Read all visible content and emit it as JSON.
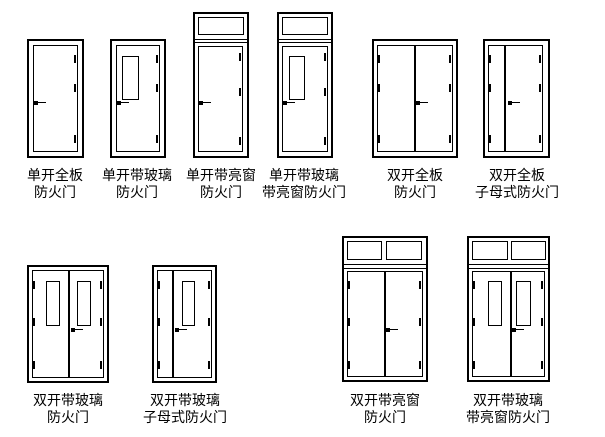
{
  "page": {
    "title": "防火门类型图例",
    "background_color": "#ffffff",
    "line_color": "#000000"
  },
  "doors": [
    {
      "id": "single-solid",
      "type": "single",
      "features": [],
      "label": [
        "单开全板",
        "防火门"
      ],
      "box": [
        27,
        39,
        57,
        119
      ],
      "label_center_x": 55,
      "label_top": 168,
      "leaves": [
        [
          6,
          6,
          45,
          107
        ]
      ],
      "glass": [],
      "transom_panes": [],
      "hlines": [],
      "hinges": [
        [
          47,
          16
        ],
        [
          47,
          45
        ],
        [
          47,
          96
        ]
      ],
      "handle": [
        7,
        62
      ]
    },
    {
      "id": "single-glass",
      "type": "single",
      "features": [
        "glass"
      ],
      "label": [
        "单开带玻璃",
        "防火门"
      ],
      "box": [
        110,
        39,
        56,
        119
      ],
      "label_center_x": 137,
      "label_top": 168,
      "leaves": [
        [
          6,
          6,
          44,
          107
        ]
      ],
      "glass": [
        [
          12,
          17,
          17,
          44
        ]
      ],
      "transom_panes": [],
      "hlines": [],
      "hinges": [
        [
          46,
          16
        ],
        [
          46,
          45
        ],
        [
          46,
          96
        ]
      ],
      "handle": [
        7,
        62
      ]
    },
    {
      "id": "single-transom",
      "type": "single",
      "features": [
        "transom"
      ],
      "label": [
        "单开带亮窗",
        "防火门"
      ],
      "box": [
        193,
        12,
        56,
        146
      ],
      "label_center_x": 221,
      "label_top": 168,
      "leaves": [
        [
          5,
          34,
          45,
          106
        ]
      ],
      "glass": [],
      "transom_panes": [
        [
          5,
          5,
          46,
          18
        ]
      ],
      "hlines": [
        27,
        30
      ],
      "hinges": [
        [
          46,
          41
        ],
        [
          46,
          76
        ],
        [
          46,
          125
        ]
      ],
      "handle": [
        6,
        89
      ]
    },
    {
      "id": "single-glass-transom",
      "type": "single",
      "features": [
        "glass",
        "transom"
      ],
      "label": [
        "单开带玻璃",
        "带亮窗防火门"
      ],
      "box": [
        277,
        12,
        56,
        146
      ],
      "label_center_x": 304,
      "label_top": 168,
      "leaves": [
        [
          5,
          34,
          46,
          106
        ]
      ],
      "glass": [
        [
          12,
          44,
          16,
          44
        ]
      ],
      "transom_panes": [
        [
          5,
          5,
          46,
          18
        ]
      ],
      "hlines": [
        27,
        30
      ],
      "hinges": [
        [
          47,
          41
        ],
        [
          47,
          76
        ],
        [
          47,
          125
        ]
      ],
      "handle": [
        6,
        89
      ]
    },
    {
      "id": "double-solid",
      "type": "double",
      "features": [],
      "label": [
        "双开全板",
        "防火门"
      ],
      "box": [
        372,
        39,
        86,
        119
      ],
      "label_center_x": 415,
      "label_top": 168,
      "leaves": [
        [
          5,
          6,
          38,
          107
        ],
        [
          43,
          6,
          38,
          107
        ]
      ],
      "glass": [],
      "transom_panes": [],
      "hlines": [],
      "hinges": [
        [
          6,
          16
        ],
        [
          6,
          45
        ],
        [
          6,
          96
        ],
        [
          77,
          16
        ],
        [
          77,
          45
        ],
        [
          77,
          96
        ]
      ],
      "handle": [
        44,
        62
      ]
    },
    {
      "id": "double-solid-mother-child",
      "type": "double-unequal",
      "features": [],
      "label": [
        "双开全板",
        "子母式防火门"
      ],
      "box": [
        483,
        39,
        67,
        119
      ],
      "label_center_x": 517,
      "label_top": 168,
      "leaves": [
        [
          5,
          6,
          17,
          107
        ],
        [
          22,
          6,
          38,
          107
        ]
      ],
      "glass": [],
      "transom_panes": [],
      "hlines": [],
      "hinges": [
        [
          6,
          16
        ],
        [
          6,
          45
        ],
        [
          6,
          96
        ],
        [
          56,
          16
        ],
        [
          56,
          45
        ],
        [
          56,
          96
        ]
      ],
      "handle": [
        25,
        62
      ]
    },
    {
      "id": "double-glass",
      "type": "double",
      "features": [
        "glass"
      ],
      "label": [
        "双开带玻璃",
        "防火门"
      ],
      "box": [
        27,
        265,
        82,
        118
      ],
      "label_center_x": 68,
      "label_top": 393,
      "leaves": [
        [
          5,
          5,
          37,
          108
        ],
        [
          42,
          5,
          35,
          108
        ]
      ],
      "glass": [
        [
          19,
          16,
          14,
          45
        ],
        [
          50,
          16,
          14,
          45
        ]
      ],
      "transom_panes": [],
      "hlines": [],
      "hinges": [
        [
          6,
          16
        ],
        [
          6,
          53
        ],
        [
          6,
          96
        ],
        [
          73,
          16
        ],
        [
          73,
          53
        ],
        [
          73,
          96
        ]
      ],
      "handle": [
        44,
        63
      ]
    },
    {
      "id": "double-glass-mother-child",
      "type": "double-unequal",
      "features": [
        "glass"
      ],
      "label": [
        "双开带玻璃",
        "子母式防火门"
      ],
      "box": [
        152,
        265,
        65,
        118
      ],
      "label_center_x": 185,
      "label_top": 393,
      "leaves": [
        [
          5,
          5,
          16,
          108
        ],
        [
          21,
          5,
          39,
          108
        ]
      ],
      "glass": [
        [
          30,
          16,
          13,
          45
        ]
      ],
      "transom_panes": [],
      "hlines": [],
      "hinges": [
        [
          6,
          16
        ],
        [
          6,
          53
        ],
        [
          6,
          96
        ],
        [
          56,
          16
        ],
        [
          56,
          53
        ],
        [
          56,
          96
        ]
      ],
      "handle": [
        23,
        63
      ]
    },
    {
      "id": "double-transom",
      "type": "double",
      "features": [
        "transom"
      ],
      "label": [
        "双开带亮窗",
        "防火门"
      ],
      "box": [
        342,
        236,
        86,
        146
      ],
      "label_center_x": 385,
      "label_top": 393,
      "leaves": [
        [
          5,
          35,
          38,
          106
        ],
        [
          43,
          35,
          38,
          106
        ]
      ],
      "glass": [],
      "transom_panes": [
        [
          5,
          5,
          35,
          19
        ],
        [
          44,
          5,
          36,
          19
        ]
      ],
      "hlines": [
        28,
        32
      ],
      "hinges": [
        [
          6,
          45
        ],
        [
          6,
          82
        ],
        [
          6,
          125
        ],
        [
          77,
          45
        ],
        [
          77,
          82
        ],
        [
          77,
          125
        ]
      ],
      "handle": [
        44,
        92
      ]
    },
    {
      "id": "double-glass-transom",
      "type": "double",
      "features": [
        "glass",
        "transom"
      ],
      "label": [
        "双开带玻璃",
        "带亮窗防火门"
      ],
      "box": [
        467,
        236,
        83,
        146
      ],
      "label_center_x": 508,
      "label_top": 393,
      "leaves": [
        [
          5,
          35,
          39,
          106
        ],
        [
          44,
          35,
          34,
          106
        ]
      ],
      "glass": [
        [
          21,
          45,
          14,
          45
        ],
        [
          49,
          45,
          15,
          45
        ]
      ],
      "transom_panes": [
        [
          5,
          5,
          36,
          19
        ],
        [
          44,
          5,
          35,
          19
        ]
      ],
      "hlines": [
        28,
        32
      ],
      "hinges": [
        [
          6,
          45
        ],
        [
          6,
          82
        ],
        [
          6,
          125
        ],
        [
          74,
          45
        ],
        [
          74,
          82
        ],
        [
          74,
          125
        ]
      ],
      "handle": [
        45,
        92
      ]
    }
  ]
}
